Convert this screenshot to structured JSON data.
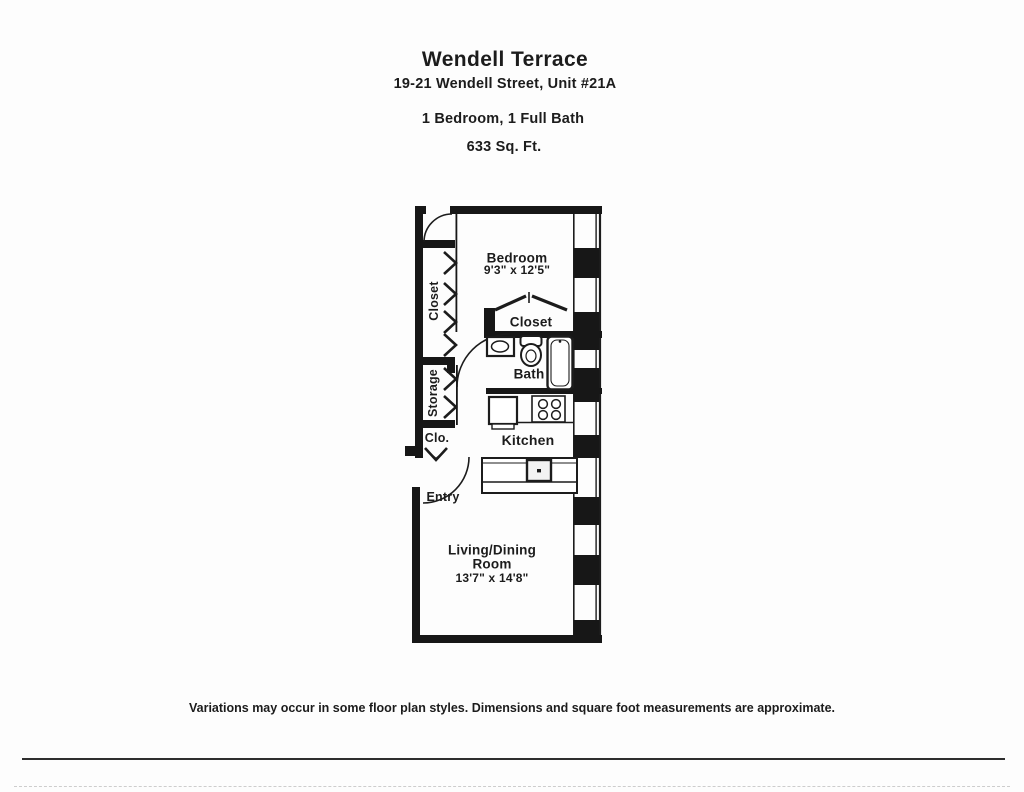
{
  "header": {
    "building": "Wendell Terrace",
    "address": "19-21 Wendell Street, Unit #21A",
    "configuration": "1 Bedroom, 1 Full Bath",
    "area": "633 Sq. Ft."
  },
  "floorplan": {
    "rooms": {
      "bedroom": {
        "name": "Bedroom",
        "dims": "9'3\" x 12'5\""
      },
      "closet_hall": {
        "name": "Closet"
      },
      "closet_bedroom": {
        "name": "Closet"
      },
      "storage": {
        "name": "Storage"
      },
      "clo": {
        "name": "Clo."
      },
      "bath": {
        "name": "Bath"
      },
      "kitchen": {
        "name": "Kitchen"
      },
      "entry": {
        "name": "Entry"
      },
      "living": {
        "name": "Living/Dining",
        "name_line2": "Room",
        "dims": "13'7\" x 14'8\""
      }
    }
  },
  "footer": {
    "disclaimer": "Variations may occur in some floor plan styles. Dimensions and square foot measurements are approximate."
  },
  "colors": {
    "ink": "#1c1c1c",
    "paper": "#fdfdfd"
  }
}
